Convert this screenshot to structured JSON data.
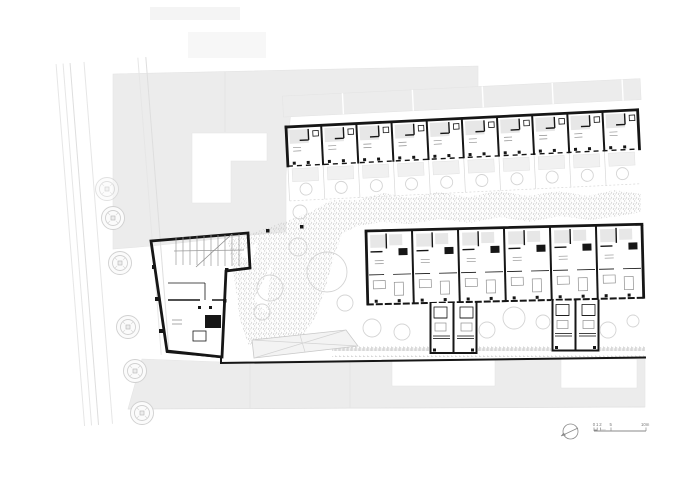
{
  "plan": {
    "scale_bar": {
      "labels": [
        "0",
        "1",
        "2",
        "5",
        "10m"
      ]
    },
    "icons": {
      "north_arrow": "north-arrow-icon"
    },
    "colors": {
      "wall": "#161616",
      "neighbor_fill": "#ececec",
      "room_fill": "#e7e7e7",
      "terrace_fill": "#f1f1f1",
      "stipple": "#c7c7c7",
      "tree_stroke": "#d4d4d4",
      "street_line": "#e6e6e6",
      "annotation": "#8a8a8a"
    }
  }
}
